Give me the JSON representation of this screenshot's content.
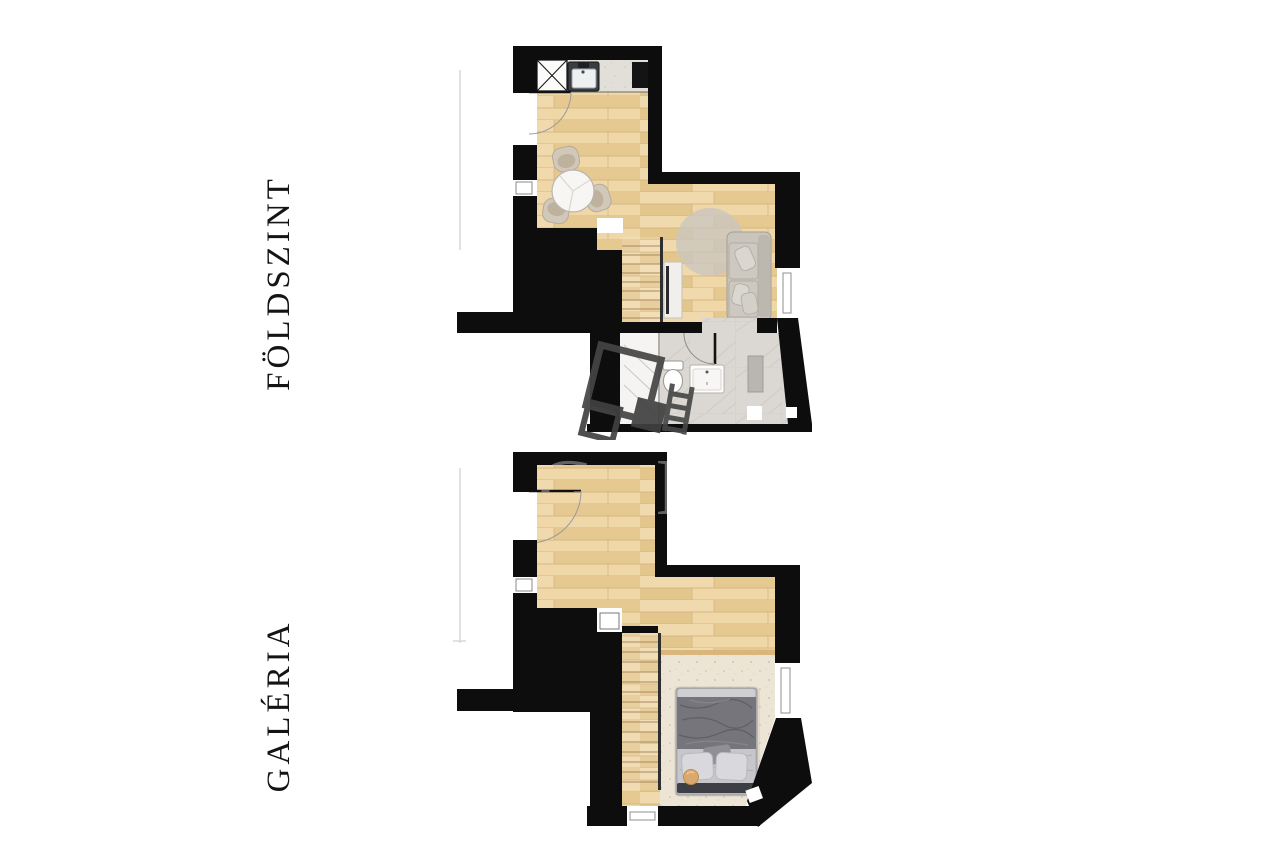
{
  "sheet": {
    "background": "#ffffff"
  },
  "floors": [
    {
      "id": "foldszint",
      "label": "FÖLDSZINT",
      "rooms": [
        "kitchen",
        "dining-area",
        "living-area",
        "staircase",
        "bathroom"
      ],
      "furniture": [
        "kitchen-counter",
        "hob",
        "kitchen-sink",
        "refrigerator",
        "dining-table",
        "chair",
        "chair",
        "chair",
        "rug",
        "sofa",
        "tv-cabinet",
        "wardrobe",
        "stairs",
        "shower",
        "toilet",
        "washbasin"
      ]
    },
    {
      "id": "galeria",
      "label": "GALÉRIA",
      "rooms": [
        "open-gallery",
        "sleeping-area",
        "staircase"
      ],
      "furniture": [
        "double-bed",
        "pillow",
        "pillow",
        "carpet",
        "stool",
        "stairs"
      ]
    }
  ],
  "watermark": {
    "letters": "G D"
  },
  "colors": {
    "wall": "#0d0d0d",
    "wood_floor": "#ecd3a1",
    "wood_seam": "#d3b37c",
    "counter": "#e2ded8",
    "tile": "#dbd7d2",
    "carpet": "#ece5d5",
    "rug": "#cac6be",
    "sofa": "#c9c5bd",
    "bed_duvet": "#75757b",
    "bed_blanket": "#c7c7cb",
    "stool": "#d9a96e",
    "watermark_gray": "#474747",
    "label_text": "#141414"
  }
}
